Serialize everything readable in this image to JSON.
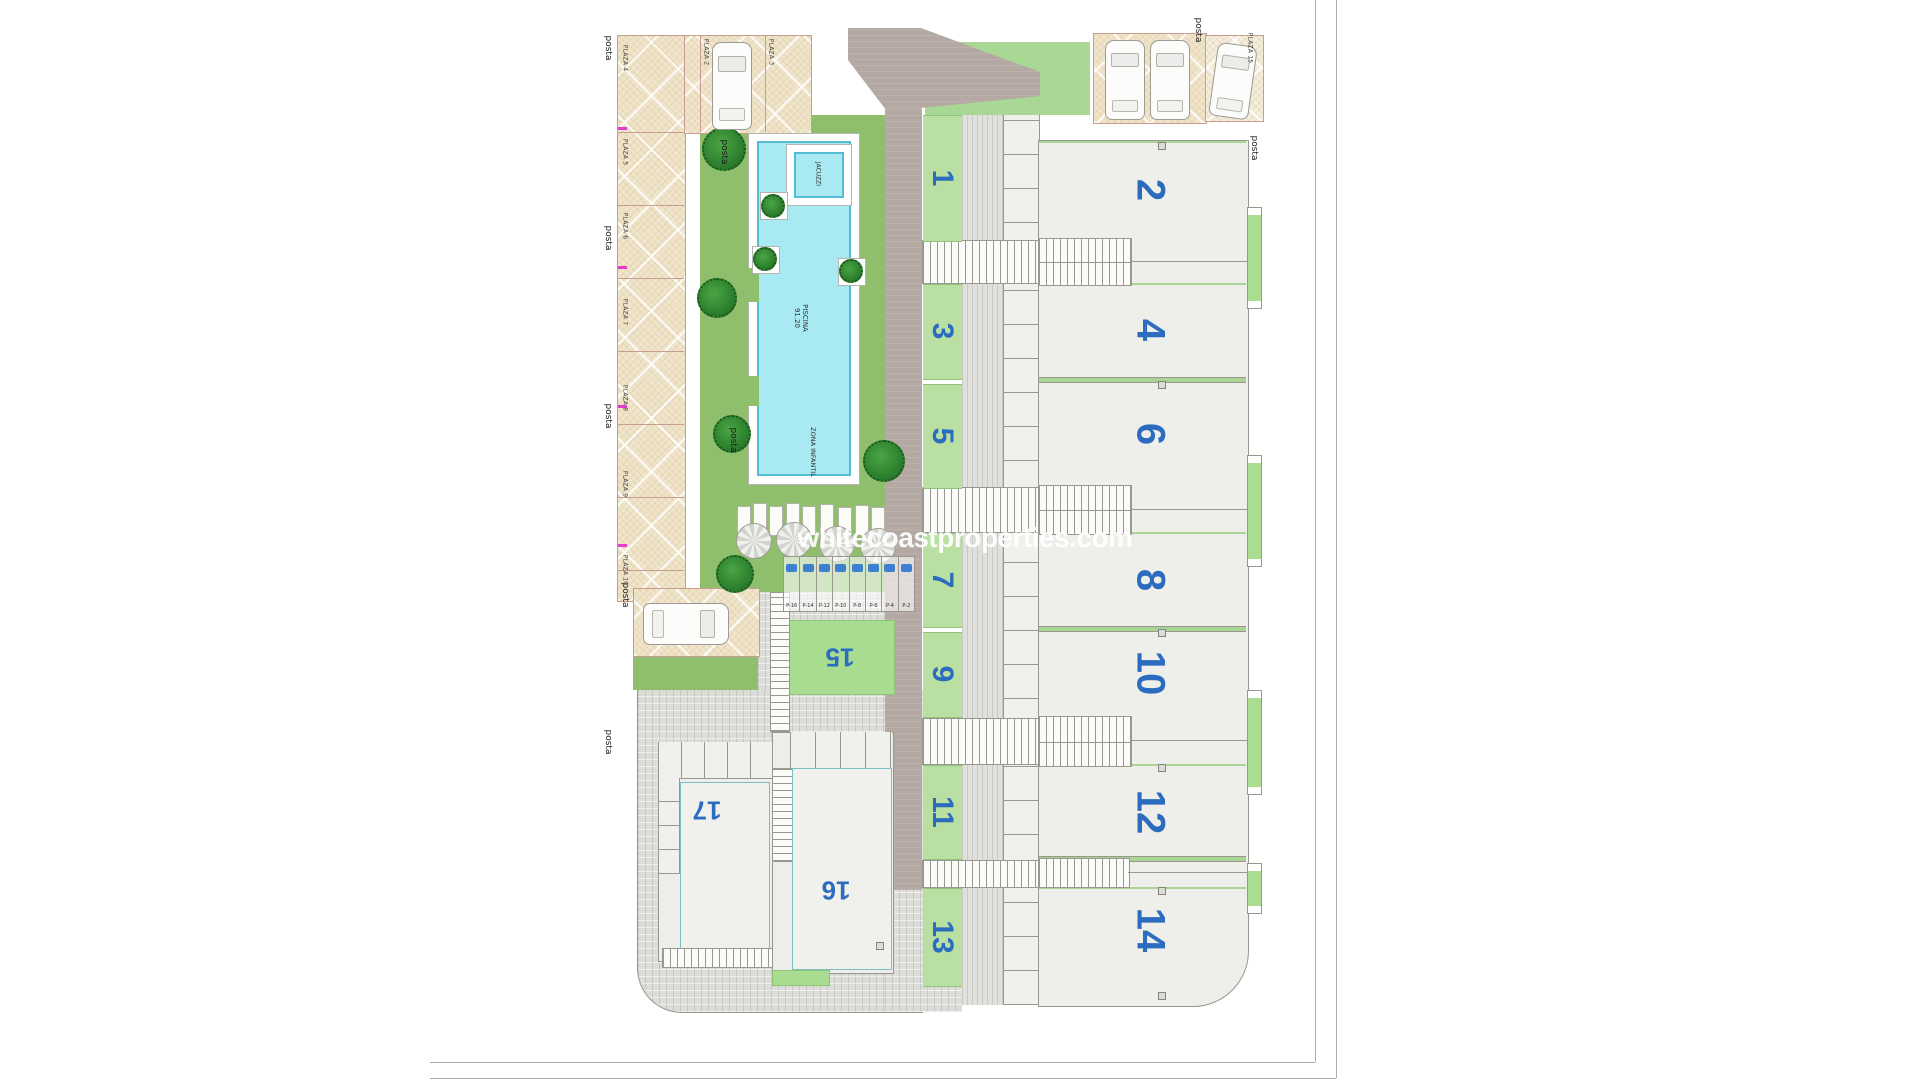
{
  "watermark": {
    "text": "whitecoastproperties.com"
  },
  "labels": {
    "posta": "posta",
    "jacuzzi": "JACUZZI",
    "piscina": "PISCINA",
    "piscina_area": "91.20",
    "zona_infantil": "ZONA INFANTIL"
  },
  "plazas": {
    "left": [
      "PLAZA 4",
      "PLAZA 5",
      "PLAZA 6",
      "PLAZA 7",
      "PLAZA 8",
      "PLAZA 9",
      "PLAZA 10"
    ],
    "top": [
      "PLAZA 2",
      "PLAZA 3"
    ],
    "right": [
      "PLAZA 15"
    ]
  },
  "small_parking": {
    "labels": [
      "P-16",
      "P-14",
      "P-12",
      "P-10",
      "P-8",
      "P-6",
      "P-4",
      "P-2"
    ]
  },
  "units": {
    "garden_strips": [
      "1",
      "3",
      "5",
      "7",
      "9",
      "11",
      "13"
    ],
    "buildings": [
      "2",
      "4",
      "6",
      "8",
      "10",
      "12",
      "14"
    ],
    "bottom_units": [
      "15",
      "16",
      "17"
    ]
  },
  "colors": {
    "unit_number_blue": "#2b6cbf",
    "pool_water": "#a9e9f1",
    "garden_green": "#8fbe6c",
    "strip_green": "#b9e0a2",
    "canopy_beige": "#f0e5cb",
    "road_taupe": "#b3a9a2",
    "building_fill": "#eeeeea",
    "tree_green": "#2f9130",
    "marker_pink": "#e23ec8"
  }
}
